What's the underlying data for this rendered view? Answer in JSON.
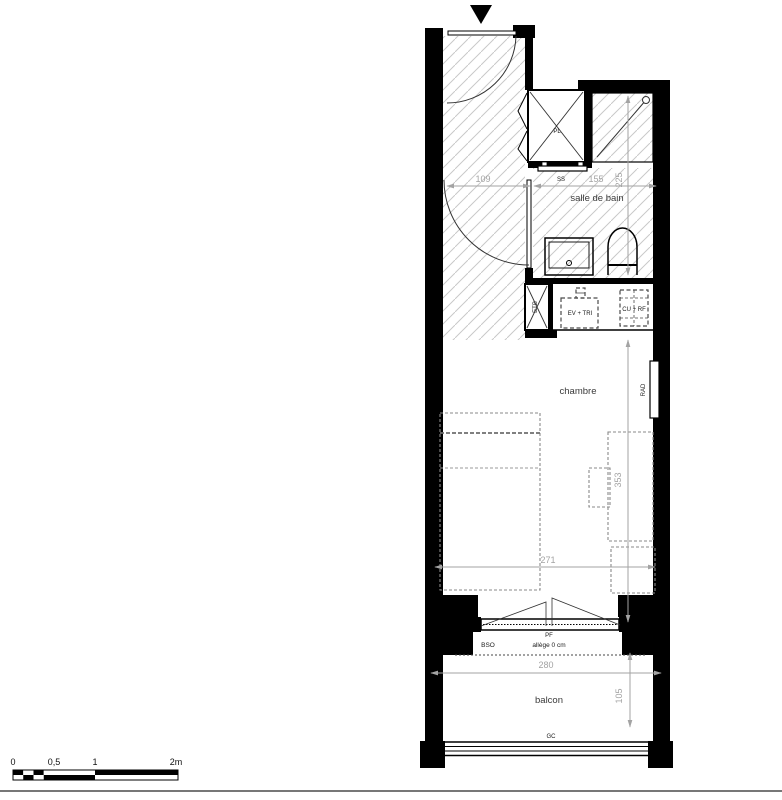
{
  "plan_type": "studio-apartment-floor-plan",
  "rooms": {
    "bathroom": "salle de bain",
    "bedroom": "chambre",
    "balcony": "balcon"
  },
  "labels": {
    "closet": "PL",
    "towel_dryer": "SS",
    "duct": "ETB",
    "sink_unit": "EV + TRI",
    "kitchenette": "CU + RF",
    "radiator": "RAD",
    "french_window": "PF",
    "blind": "BSO",
    "sill": "allège 0 cm",
    "guardrail": "GC"
  },
  "dimensions": {
    "entry_width": "109",
    "bathroom_width": "155",
    "bathroom_depth": "225",
    "bedroom_width": "271",
    "bedroom_depth": "353",
    "balcony_width": "280",
    "balcony_depth": "105"
  },
  "scale_bar": {
    "ticks": [
      "0",
      "0,5",
      "1",
      "2m"
    ]
  },
  "colors": {
    "wall": "#000000",
    "hatch": "#c9c9c9",
    "dimension": "#a3a3a3",
    "furniture_dashed": "#8a8a8a"
  }
}
